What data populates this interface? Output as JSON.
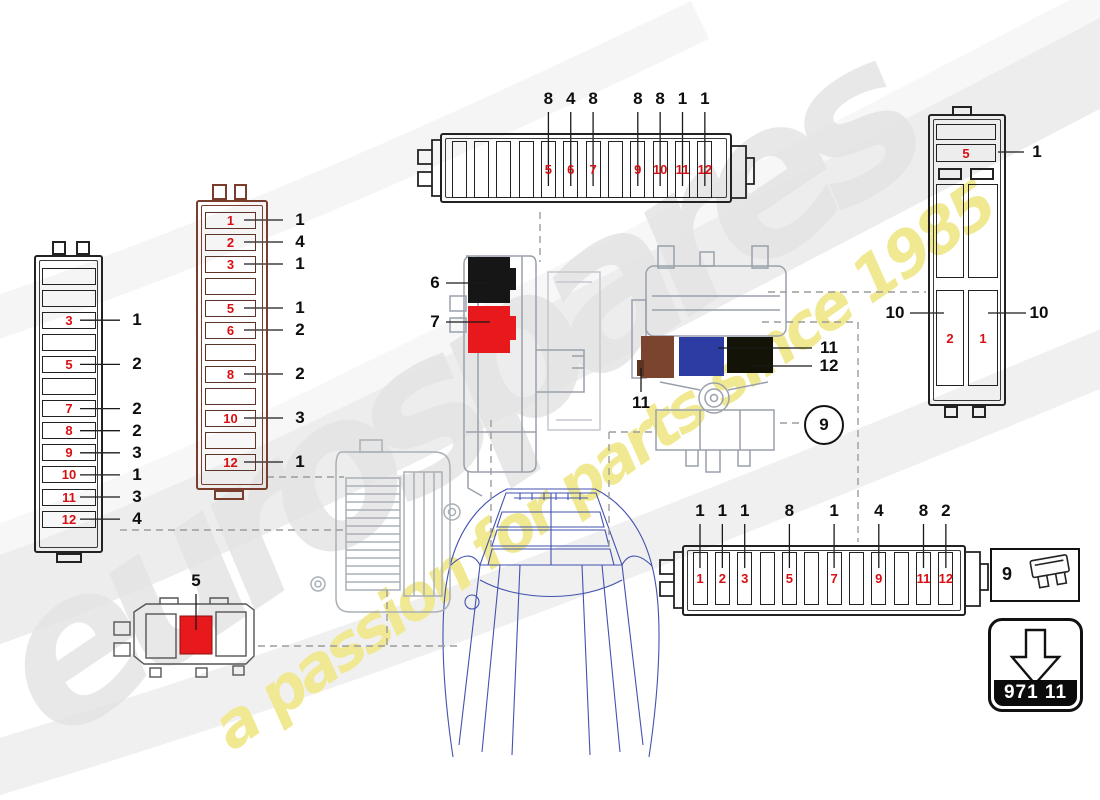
{
  "diagram": {
    "brand": "eurospares",
    "tagline": "a passion for parts since 1985",
    "part_number": "971 11",
    "colors": {
      "fuse_label_red": "#d80f12",
      "callout_black": "#0e0e0e",
      "relay_black": "#161616",
      "relay_red": "#e8191c",
      "relay_brown": "#7b442e",
      "relay_blue": "#2d3ca3",
      "relay_dark": "#131307",
      "fuse_red": "#e8191c",
      "mid_block_outline": "#7a3c2c",
      "drawing_gray": "#9aa1ab",
      "car_blue": "#4252b0",
      "dash_gray": "#9c9c9c",
      "watermark_gray": "#e4e4e4",
      "watermark_yellow": "#f0e88d"
    }
  },
  "blocks": {
    "top_strip": {
      "slot_labels": [
        "",
        "",
        "",
        "",
        "5",
        "6",
        "7",
        "",
        "9",
        "10",
        "11",
        "12"
      ],
      "callouts": [
        {
          "label": "8",
          "slot": 5
        },
        {
          "label": "4",
          "slot": 6
        },
        {
          "label": "8",
          "slot": 7
        },
        {
          "label": "8",
          "slot": 9
        },
        {
          "label": "8",
          "slot": 10
        },
        {
          "label": "1",
          "slot": 11
        },
        {
          "label": "1",
          "slot": 12
        }
      ]
    },
    "left_block": {
      "slot_labels": [
        "",
        "",
        "3",
        "",
        "5",
        "",
        "7",
        "8",
        "9",
        "10",
        "11",
        "12"
      ],
      "callouts": [
        {
          "label": "1",
          "slot": 3
        },
        {
          "label": "2",
          "slot": 5
        },
        {
          "label": "2",
          "slot": 7
        },
        {
          "label": "2",
          "slot": 8
        },
        {
          "label": "3",
          "slot": 9
        },
        {
          "label": "1",
          "slot": 10
        },
        {
          "label": "3",
          "slot": 11
        },
        {
          "label": "4",
          "slot": 12
        }
      ]
    },
    "mid_block": {
      "slot_labels": [
        "1",
        "2",
        "3",
        "",
        "5",
        "6",
        "",
        "8",
        "",
        "10",
        "",
        "12"
      ],
      "callouts": [
        {
          "label": "1",
          "slot": 1
        },
        {
          "label": "4",
          "slot": 2
        },
        {
          "label": "1",
          "slot": 3
        },
        {
          "label": "1",
          "slot": 5
        },
        {
          "label": "2",
          "slot": 6
        },
        {
          "label": "2",
          "slot": 8
        },
        {
          "label": "3",
          "slot": 10
        },
        {
          "label": "1",
          "slot": 12
        }
      ]
    },
    "bottom_strip": {
      "slot_labels": [
        "1",
        "2",
        "3",
        "",
        "5",
        "",
        "7",
        "",
        "9",
        "",
        "11",
        "12"
      ],
      "callouts": [
        {
          "label": "1",
          "slot": 1
        },
        {
          "label": "1",
          "slot": 2
        },
        {
          "label": "1",
          "slot": 3
        },
        {
          "label": "8",
          "slot": 5
        },
        {
          "label": "1",
          "slot": 7
        },
        {
          "label": "4",
          "slot": 9
        },
        {
          "label": "8",
          "slot": 11
        },
        {
          "label": "2",
          "slot": 12
        }
      ]
    },
    "right_block": {
      "top_slot": "5",
      "top_callout": "1",
      "left_slot": "2",
      "right_slot": "1",
      "left_callout": "10",
      "right_callout": "10"
    },
    "relay_carrier": {
      "black_callout": "6",
      "red_callout": "7"
    },
    "relay_block": {
      "blue_callout": "11",
      "dark_callout": "12",
      "brown_callout": "11",
      "circle_ref": "9"
    },
    "fuse_holder": {
      "callout": "5"
    },
    "legend": {
      "ref": "9"
    }
  }
}
